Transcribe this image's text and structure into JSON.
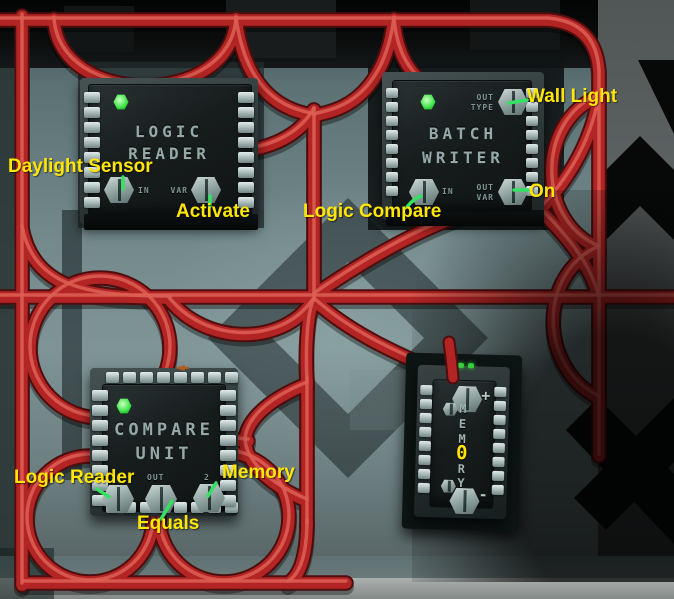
{
  "scene": {
    "description": "Stationeers logic wall with red data cables connecting logic chips"
  },
  "colors": {
    "cable_red": "#b32424",
    "annotation_yellow": "#ffe605",
    "tick_green": "#35e062",
    "led_green": "#3ae341",
    "wall_teal": "#7e9496"
  },
  "chips": {
    "logic_reader": {
      "title1": "LOGIC",
      "title2": "READER",
      "port_in": "IN",
      "port_var": "VAR"
    },
    "batch_writer": {
      "title1": "BATCH",
      "title2": "WRITER",
      "port_out_top": "OUT",
      "port_type_top": "TYPE",
      "port_in": "IN",
      "port_out_bottom": "OUT",
      "port_var_bottom": "VAR"
    },
    "compare_unit": {
      "title1": "COMPARE",
      "title2": "UNIT",
      "port_out": "OUT",
      "port_two": "2"
    },
    "memory": {
      "l1": "M",
      "l2": "E",
      "l3": "M",
      "value": "0",
      "l4": "R",
      "l5": "Y",
      "plus": "+",
      "minus": "-"
    }
  },
  "annotations": {
    "daylight_sensor": "Daylight Sensor",
    "activate": "Activate",
    "logic_compare": "Logic Compare",
    "wall_light": "Wall Light",
    "on": "On",
    "logic_reader": "Logic Reader",
    "equals": "Equals",
    "memory": "Memory"
  }
}
